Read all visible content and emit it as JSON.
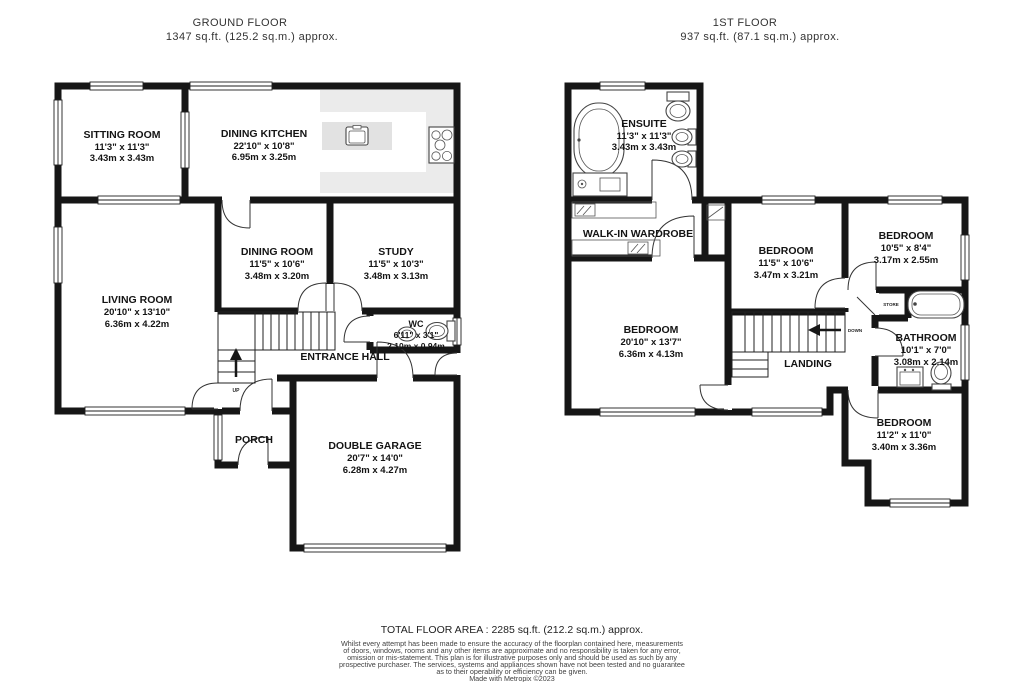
{
  "titles": {
    "ground": {
      "line1": "GROUND FLOOR",
      "line2": "1347 sq.ft. (125.2 sq.m.) approx."
    },
    "first": {
      "line1": "1ST FLOOR",
      "line2": "937 sq.ft. (87.1 sq.m.) approx."
    }
  },
  "ground": {
    "sitting_room": {
      "name": "SITTING ROOM",
      "imperial": "11'3\" x 11'3\"",
      "metric": "3.43m x 3.43m"
    },
    "dining_kitchen": {
      "name": "DINING KITCHEN",
      "imperial": "22'10\" x 10'8\"",
      "metric": "6.95m x 3.25m"
    },
    "dining_room": {
      "name": "DINING ROOM",
      "imperial": "11'5\" x 10'6\"",
      "metric": "3.48m x 3.20m"
    },
    "study": {
      "name": "STUDY",
      "imperial": "11'5\" x 10'3\"",
      "metric": "3.48m x 3.13m"
    },
    "living_room": {
      "name": "LIVING ROOM",
      "imperial": "20'10\" x 13'10\"",
      "metric": "6.36m x 4.22m"
    },
    "wc": {
      "name": "WC",
      "imperial": "6'11\" x 3'1\"",
      "metric": "2.10m x 0.94m"
    },
    "entrance_hall": {
      "name": "ENTRANCE HALL"
    },
    "porch": {
      "name": "PORCH"
    },
    "double_garage": {
      "name": "DOUBLE GARAGE",
      "imperial": "20'7\" x 14'0\"",
      "metric": "6.28m x 4.27m"
    },
    "up_label": "UP"
  },
  "first": {
    "ensuite": {
      "name": "ENSUITE",
      "imperial": "11'3\" x 11'3\"",
      "metric": "3.43m x 3.43m"
    },
    "wardrobe": {
      "name": "WALK-IN WARDROBE"
    },
    "bedroom_mid": {
      "name": "BEDROOM",
      "imperial": "11'5\" x 10'6\"",
      "metric": "3.47m x 3.21m"
    },
    "bedroom_topright": {
      "name": "BEDROOM",
      "imperial": "10'5\" x 8'4\"",
      "metric": "3.17m x 2.55m"
    },
    "bedroom_master": {
      "name": "BEDROOM",
      "imperial": "20'10\" x 13'7\"",
      "metric": "6.36m x 4.13m"
    },
    "bathroom": {
      "name": "BATHROOM",
      "imperial": "10'1\" x 7'0\"",
      "metric": "3.08m x 2.14m"
    },
    "bedroom_bottomright": {
      "name": "BEDROOM",
      "imperial": "11'2\" x 11'0\"",
      "metric": "3.40m x 3.36m"
    },
    "landing": {
      "name": "LANDING"
    },
    "store_label": "STORE",
    "down_label": "DOWN"
  },
  "footer": {
    "total": "TOTAL FLOOR AREA : 2285 sq.ft. (212.2 sq.m.) approx.",
    "disclaimer": [
      "Whilst every attempt has been made to ensure the accuracy of the floorplan contained here, measurements",
      "of doors, windows, rooms and any other items are approximate and no responsibility is taken for any error,",
      "omission or mis-statement. This plan is for illustrative purposes only and should be used as such by any",
      "prospective purchaser. The services, systems and appliances shown have not been tested and no guarantee",
      "as to their operability or efficiency can be given."
    ],
    "credit": "Made with Metropix ©2023"
  },
  "colors": {
    "wall": "#161616",
    "counter": "#ebebeb",
    "island": "#e2e2e2",
    "fixture": "#444444"
  }
}
